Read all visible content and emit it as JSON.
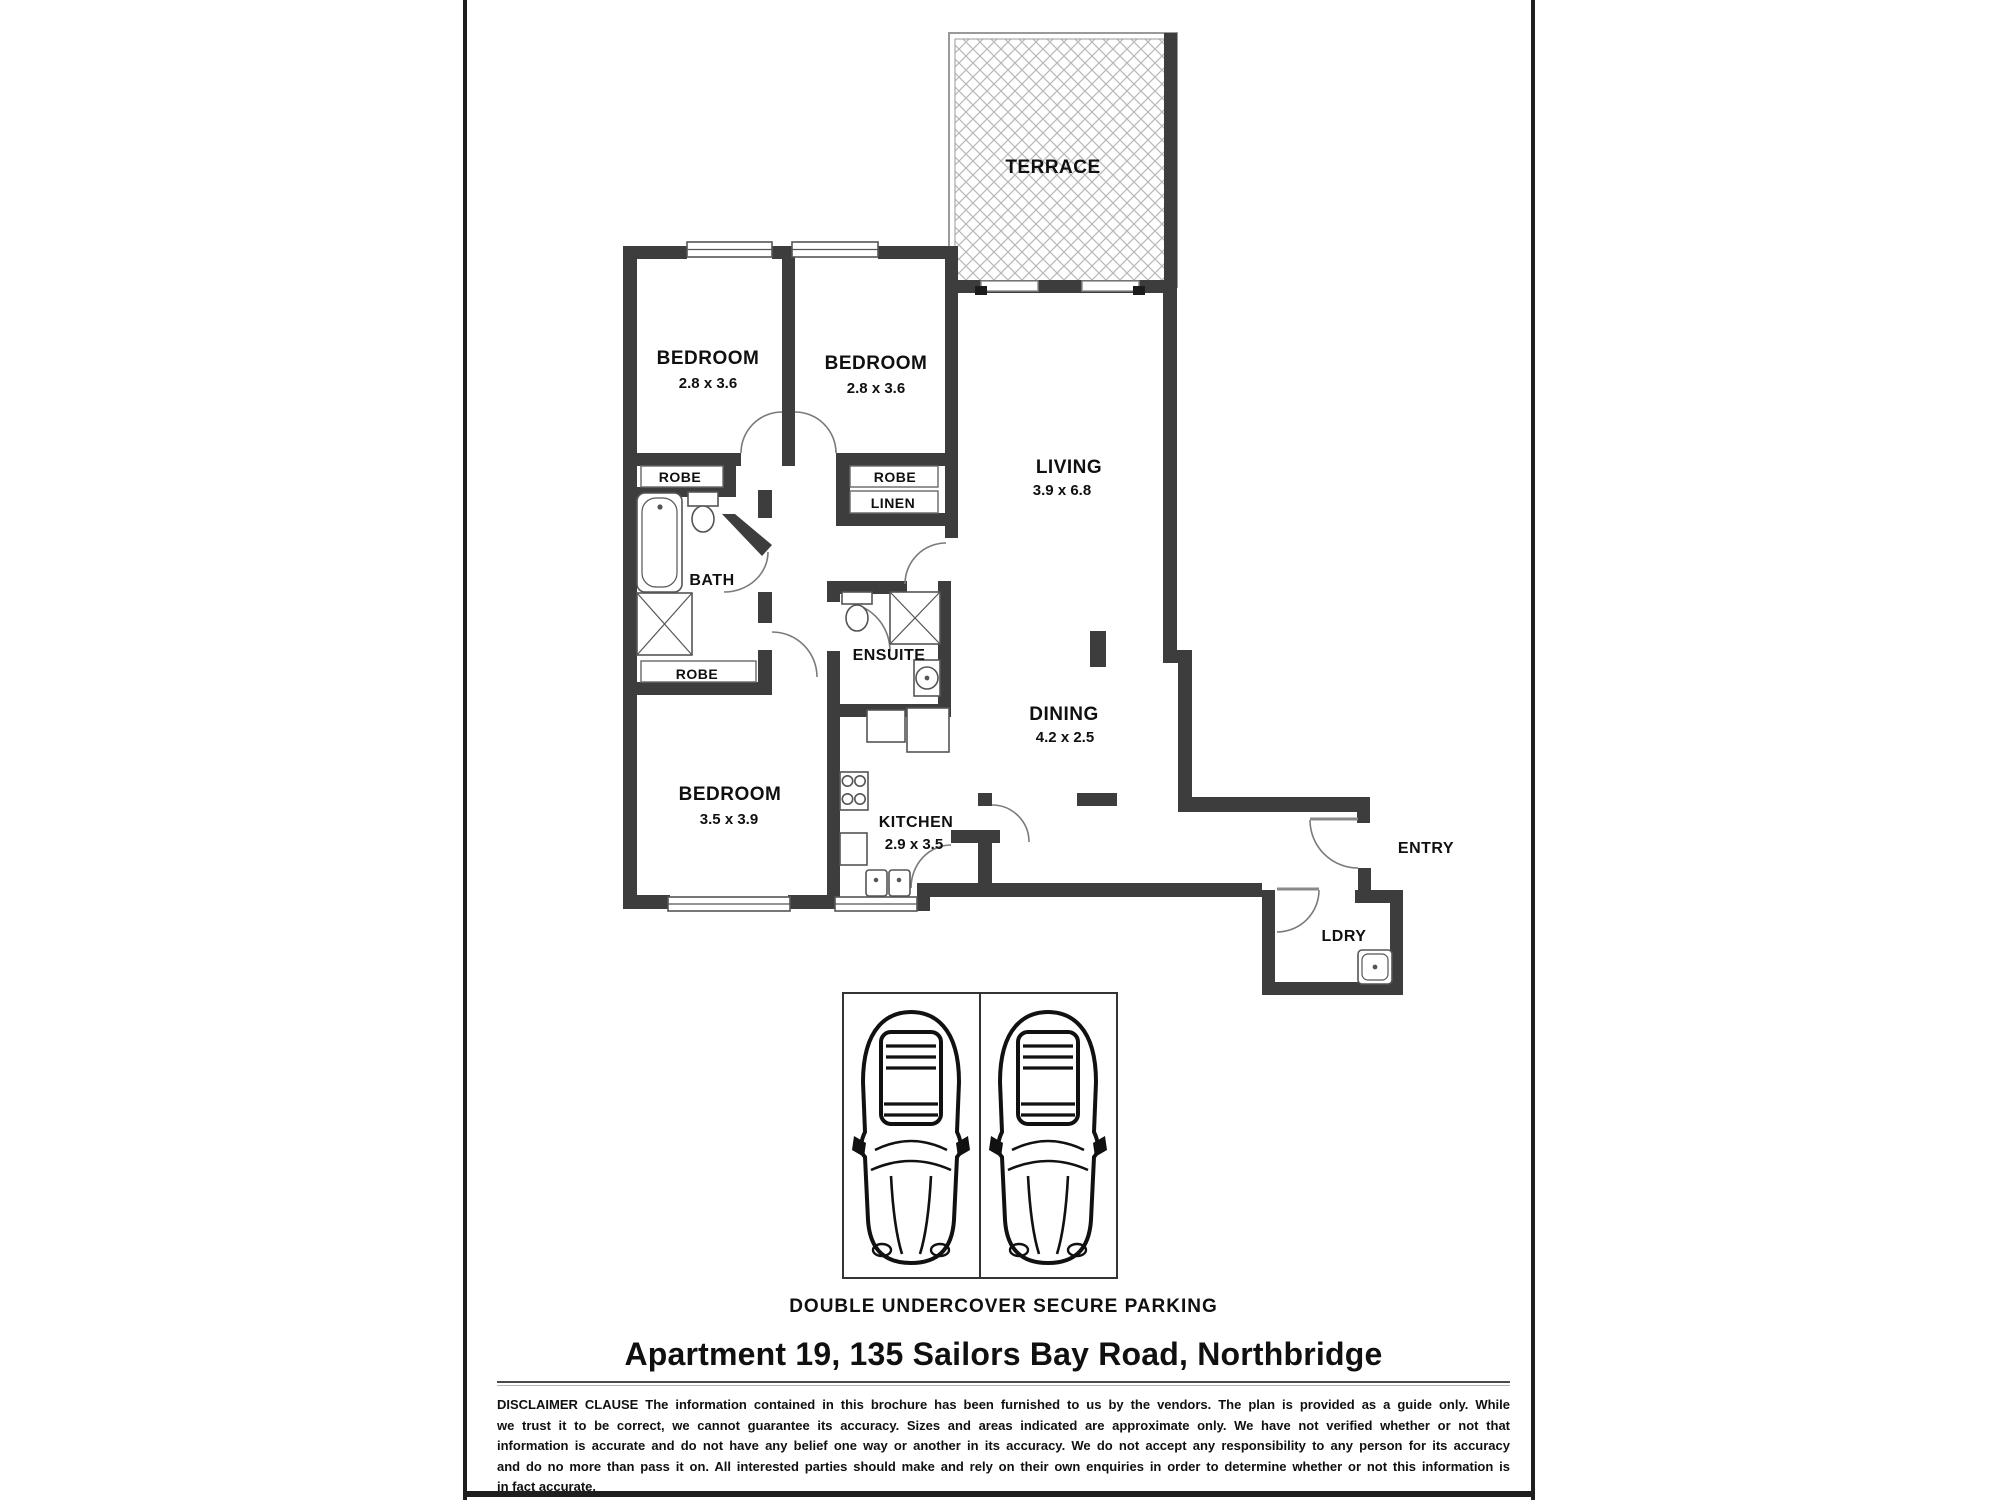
{
  "colors": {
    "wall": "#3d3d3d",
    "text": "#101010",
    "hatch": "#b8b8b8",
    "page_border": "#1f1f1f"
  },
  "plan": {
    "terrace": {
      "name": "TERRACE"
    },
    "bedroom1": {
      "name": "BEDROOM",
      "dims": "2.8 x 3.6"
    },
    "bedroom2": {
      "name": "BEDROOM",
      "dims": "2.8 x 3.6"
    },
    "bedroom3": {
      "name": "BEDROOM",
      "dims": "3.5 x 3.9"
    },
    "living": {
      "name": "LIVING",
      "dims": "3.9 x 6.8"
    },
    "dining": {
      "name": "DINING",
      "dims": "4.2 x 2.5"
    },
    "kitchen": {
      "name": "KITCHEN",
      "dims": "2.9 x 3.5"
    },
    "bath": {
      "name": "BATH"
    },
    "ensuite": {
      "name": "ENSUITE"
    },
    "entry": {
      "name": "ENTRY"
    },
    "laundry": {
      "name": "LDRY"
    },
    "robe1": {
      "name": "ROBE"
    },
    "robe2": {
      "name": "ROBE"
    },
    "robe3": {
      "name": "ROBE"
    },
    "linen": {
      "name": "LINEN"
    }
  },
  "footer": {
    "parking_caption": "DOUBLE UNDERCOVER SECURE PARKING",
    "title": "Apartment 19, 135 Sailors Bay Road, Northbridge",
    "disclaimer_lines": [
      "DISCLAIMER CLAUSE The information contained in this brochure has been furnished to us by the vendors. The plan is provided as a guide only. While",
      "we trust it to be correct, we cannot guarantee its accuracy. Sizes and areas indicated are approximate only. We have not verified whether or not that",
      "information is accurate and do not have any belief one way or another in its accuracy. We do not accept any responsibility to any person for its accuracy",
      "and do no more than pass it on. All interested parties should make and rely on their own enquiries in order to determine whether or not this information is",
      "in fact accurate."
    ]
  }
}
